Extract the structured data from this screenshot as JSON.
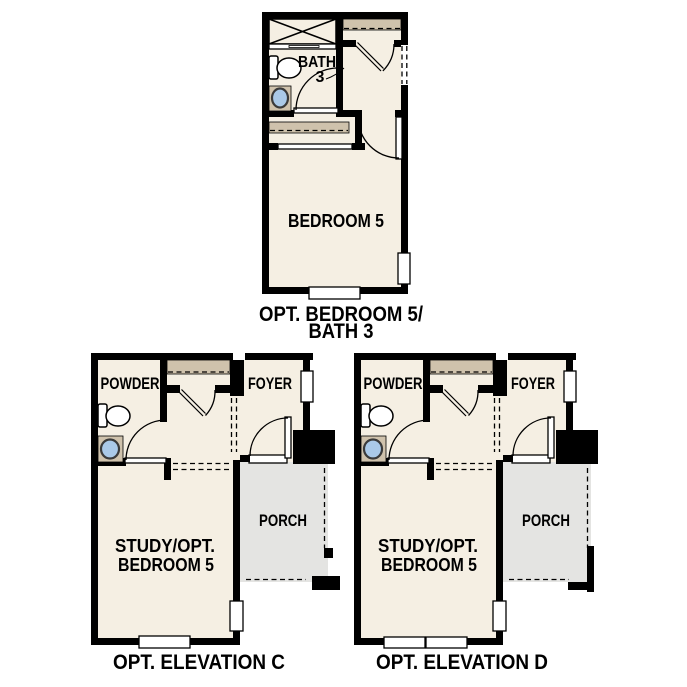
{
  "colors": {
    "paper": "#ffffff",
    "ink": "#000000",
    "wall": "#000000",
    "floor": "#f5efe3",
    "shelf": "#cfc2ac",
    "fixture_blue": "#aac9e8",
    "porch_gray": "#e4e4e2"
  },
  "plans": {
    "bedroom5_bath3": {
      "caption_line1": "OPT. BEDROOM 5/",
      "caption_line2": "BATH 3",
      "labels": {
        "bath": "BATH",
        "bath_number": "3",
        "bedroom": "BEDROOM 5"
      }
    },
    "elevation_c": {
      "caption": "OPT. ELEVATION C",
      "labels": {
        "powder": "POWDER",
        "foyer": "FOYER",
        "porch": "PORCH",
        "study_line1": "STUDY/OPT.",
        "study_line2": "BEDROOM 5"
      }
    },
    "elevation_d": {
      "caption": "OPT. ELEVATION D",
      "labels": {
        "powder": "POWDER",
        "foyer": "FOYER",
        "porch": "PORCH",
        "study_line1": "STUDY/OPT.",
        "study_line2": "BEDROOM 5"
      }
    }
  }
}
